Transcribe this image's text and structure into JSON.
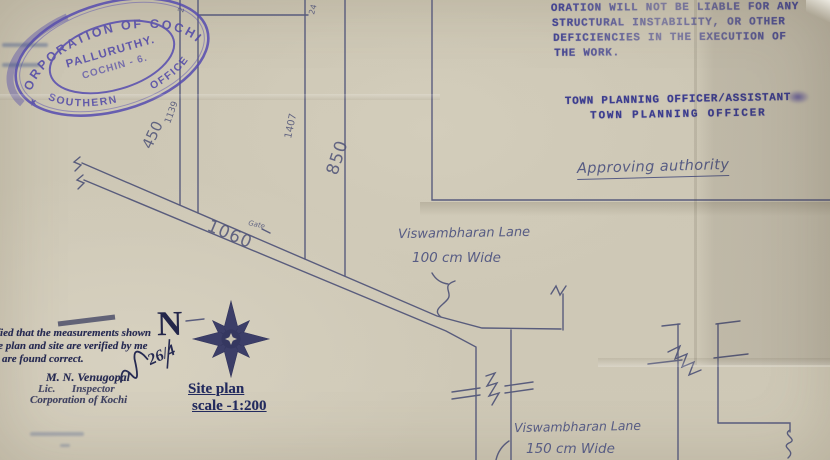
{
  "stamp": {
    "arc_top": "CORPORATION OF COCHIN",
    "arc_bottom": "SOUTHERN        OFFICE",
    "center_line1": "PALLURUTHY.",
    "center_line2": "COCHIN - 6.",
    "star": "★"
  },
  "disclaimer": {
    "line1": "ORATION WILL NOT BE LIABLE FOR ANY",
    "line2": "STRUCTURAL INSTABILITY, OR OTHER",
    "line3": "DEFICIENCIES IN THE EXECUTION OF",
    "line4": "THE WORK."
  },
  "authority": {
    "line1": "TOWN PLANNING OFFICER/ASSISTANT",
    "line2": "TOWN PLANNING OFFICER",
    "approving_label": "Approving authority"
  },
  "certification": {
    "line1": "rtified that the measurements shown",
    "line2": "the plan and site are verified by me",
    "line3": "are found correct.",
    "name": "M. N. Venugopal",
    "title": "Lic.      Inspector",
    "org": "Corporation of Kochi",
    "sig_date": "26/4"
  },
  "north": {
    "label": "N"
  },
  "titleblock": {
    "line1": "Site plan",
    "line2": "scale -1:200"
  },
  "lanes": {
    "lane1_name": "Viswambharan Lane",
    "lane1_width": "100 cm Wide",
    "lane2_name": "Viswambharan Lane",
    "lane2_width": "150 cm Wide",
    "gate": "Gate"
  },
  "dimensions": {
    "plot1": "450",
    "plot2": "1139",
    "plot3": "1407",
    "plot4": "850",
    "road": "1060",
    "top_small_a": "2",
    "top_small_b": "24"
  },
  "colors": {
    "paper": "#cdc7b5",
    "ink_blue": "#4f5378",
    "stamp_purple": "#564cb0",
    "typed_blue": "#3b3c8f",
    "print_navy": "#262a52"
  }
}
